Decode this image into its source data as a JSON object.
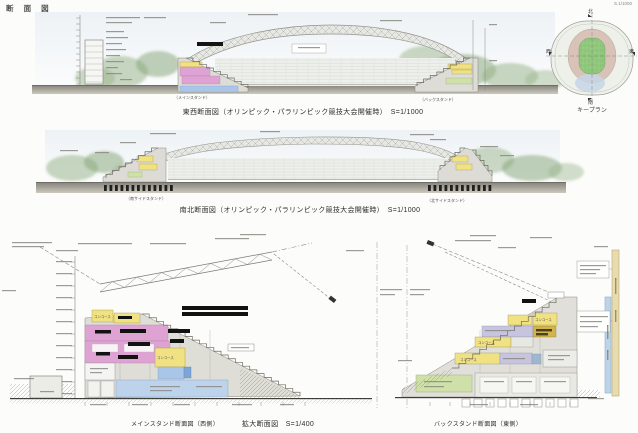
{
  "page": {
    "title": "断 面 図",
    "scale_note": "S.1/1000"
  },
  "key_plan": {
    "caption": "キープラン",
    "compass": {
      "north": "北",
      "south": "南",
      "west": "西",
      "east": "東"
    }
  },
  "sections": {
    "east_west": {
      "caption": "東西断面図（オリンピック・パラリンピック競技大会開催時）　S=1/1000",
      "left_stand": "（メインスタンド）",
      "right_stand": "（バックスタンド）"
    },
    "north_south": {
      "caption": "南北断面図（オリンピック・パラリンピック競技大会開催時）　S=1/1000",
      "left_stand": "（南サイドスタンド）",
      "right_stand": "（北サイドスタンド）"
    }
  },
  "enlarged": {
    "caption": "拡大断面図　S=1/400",
    "main_stand_caption": "メインスタンド断面図（西側）",
    "back_stand_caption": "バックスタンド断面図（東側）",
    "labels": {
      "concourse": "コンコース"
    }
  },
  "colors": {
    "concourse_yellow": "#f0e183",
    "room_pink": "#dfa3d3",
    "room_blue": "#a9c6e8",
    "room_blue_light": "#bdd3ec",
    "room_blue_dark": "#7da6d8",
    "lavender": "#c6c4de",
    "mustard": "#d2b44c",
    "room_green": "#cfe0a8",
    "pitch_green": "#8cc579",
    "stand_ring_tan": "#d9c2b8",
    "scalebar_tan": "#e8dcae",
    "scalebar_blue": "#bcd4e8"
  }
}
